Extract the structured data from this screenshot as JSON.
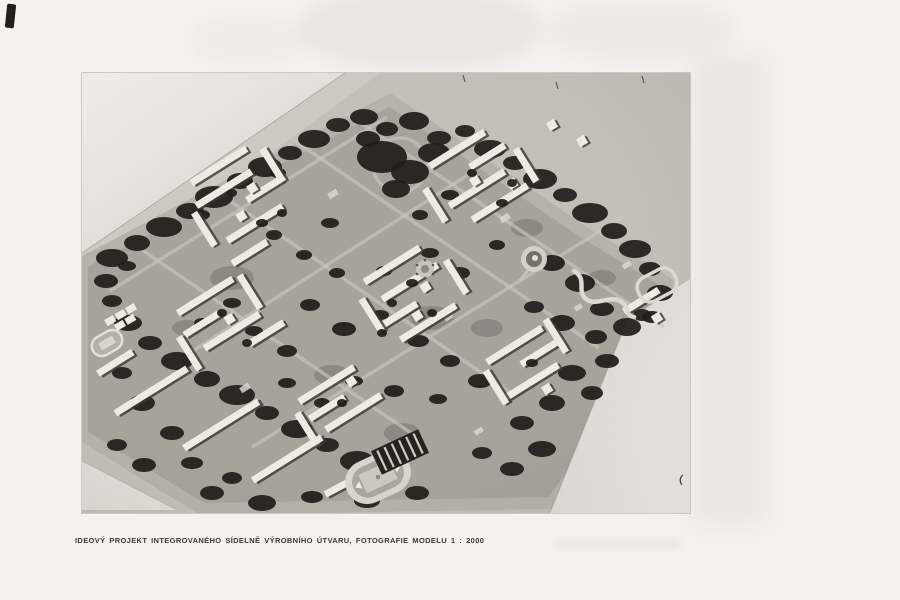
{
  "document": {
    "caption": "IDEOVÝ PROJEKT INTEGROVANÉHO SÍDELNĚ VÝROBNÍHO ÚTVARU, FOTOGRAFIE MODELU 1 : 2000"
  },
  "figure": {
    "description": "Black-and-white photograph of an architectural scale model, aerial view: a diamond-shaped base board with clusters of white slab buildings, dark tree masses, roads, a stadium with running track, a circular amphitheater and a winding road, model scale 1 : 2000",
    "scale_label": "1 : 2000"
  },
  "theme": {
    "page-bg": "#f4f2ec",
    "photo-paper": "#e8e5de",
    "board": "#c2bfb7",
    "board-band": "#b5b2aa",
    "terrain": "#a6a39b",
    "forest": "#201e1a",
    "building": "#eeebe3",
    "building-shadow": "#3a3833",
    "road": "#c8c5bd",
    "caption": "#3d3b37"
  }
}
